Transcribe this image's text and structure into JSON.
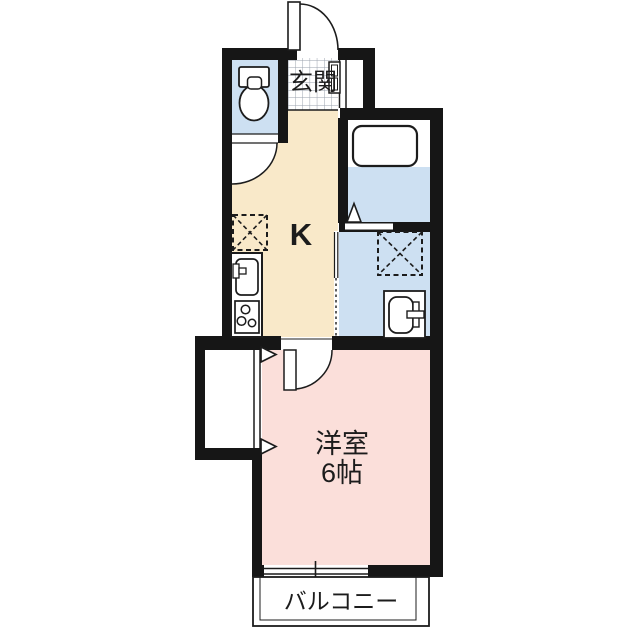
{
  "floorplan": {
    "kind": "apartment-floorplan-1K",
    "rooms": {
      "entrance": {
        "label": "玄関"
      },
      "kitchen": {
        "label": "K"
      },
      "bedroom": {
        "label": "洋室",
        "size_label": "6帖"
      },
      "balcony": {
        "label": "バルコニー"
      },
      "toilet": {
        "icon": "toilet-icon"
      },
      "bathroom": {
        "icon": "bathtub-icon"
      },
      "washroom": {
        "icon": "washbasin-icon"
      }
    },
    "fixtures": {
      "refrigerator_space": "dashed-x-box",
      "washer_space": "dashed-x-box",
      "kitchen_sink": "sink-with-faucet",
      "stove": "three-burner-stove",
      "shoe_cabinet": "small-shelf-box"
    },
    "colors": {
      "wall": "#161616",
      "kitchen_floor": "#F9E9C9",
      "bedroom_floor": "#FBDFDA",
      "wet_area_floor": "#CDE0F2",
      "tile_line": "#9aa2ad",
      "line": "#1c1c1c",
      "background": "#FFFFFF"
    }
  }
}
